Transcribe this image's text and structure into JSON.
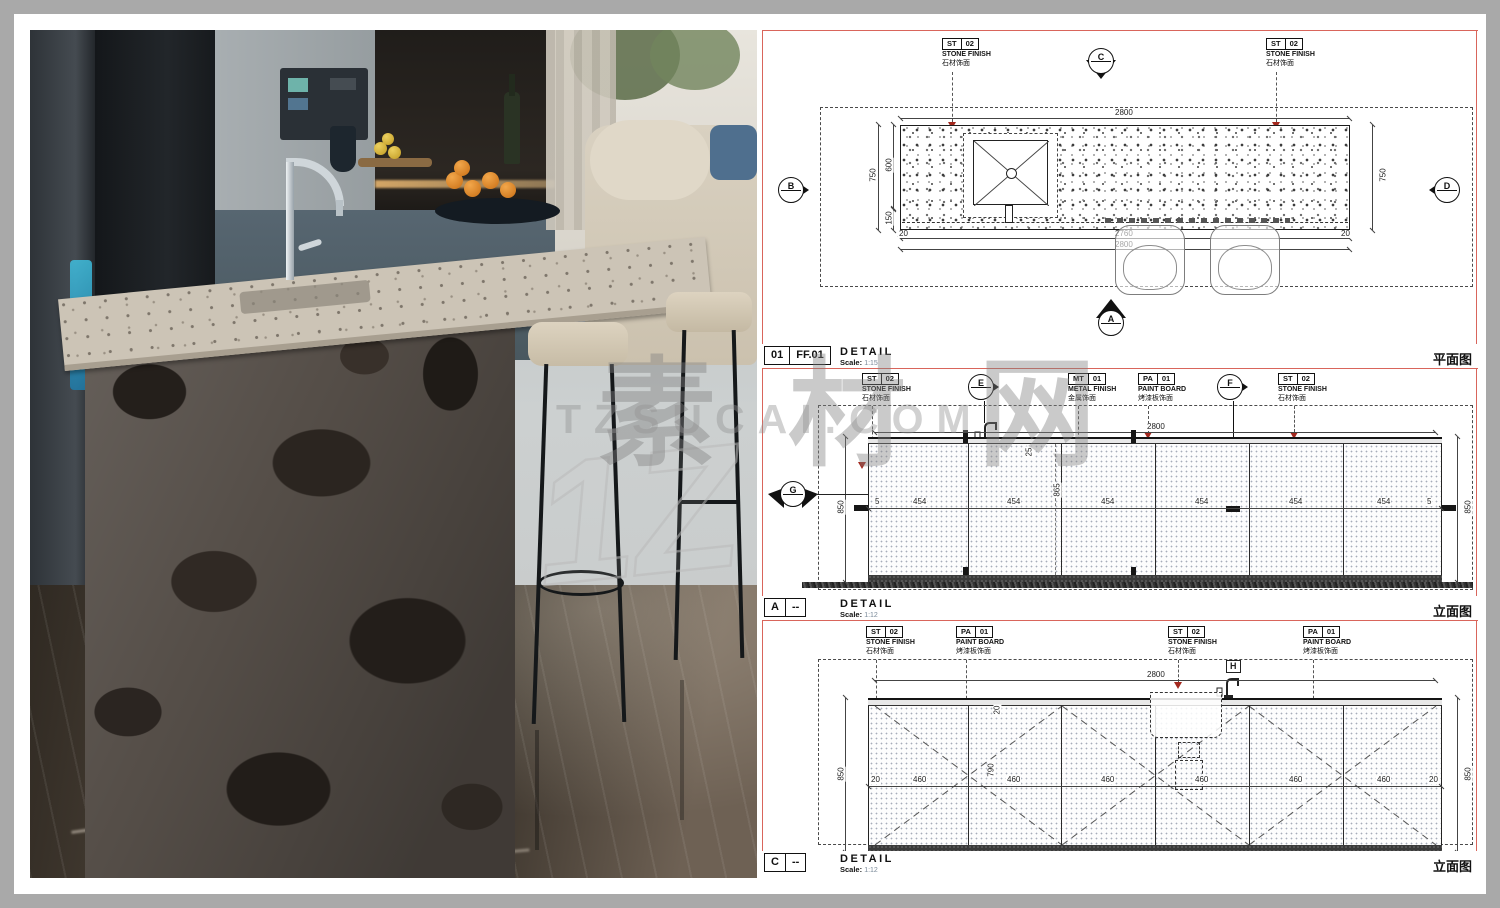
{
  "watermark": {
    "cn": "素材网",
    "url": "TZSUCAI.COM",
    "logo": "1Z"
  },
  "materials": {
    "st": {
      "code": "ST",
      "num": "02",
      "en": "STONE FINISH",
      "cn": "石材饰面"
    },
    "mt": {
      "code": "MT",
      "num": "01",
      "en": "METAL FINISH",
      "cn": "金属饰面"
    },
    "pa": {
      "code": "PA",
      "num": "01",
      "en": "PAINT BOARD",
      "cn": "烤漆板饰面"
    }
  },
  "plan": {
    "markers": {
      "top": "C",
      "left": "B",
      "right": "D",
      "bottom": "A"
    },
    "dims": {
      "top": "2800",
      "left": "750",
      "left_a": "600",
      "left_b": "150",
      "right": "750",
      "bot_l": "20",
      "bot_m": "2760",
      "bot_r": "20",
      "bot_total": "2800"
    },
    "title": {
      "c1": "01",
      "c2": "FF.01",
      "name": "DETAIL",
      "scale_key": "Scale:",
      "scale_val": "1:15",
      "view": "平面图"
    }
  },
  "elevA": {
    "markers": {
      "cut_left": "G",
      "mid": "E",
      "cut_right": "F"
    },
    "dims": {
      "top": "2800",
      "left": "850",
      "right": "850",
      "edge_l": "5",
      "edge_r": "5",
      "vmid": "865",
      "step": "25",
      "row": [
        "454",
        "454",
        "454",
        "454",
        "454",
        "454"
      ]
    },
    "title": {
      "c1": "A",
      "c2": "--",
      "name": "DETAIL",
      "scale_key": "Scale:",
      "scale_val": "1:12",
      "view": "立面图"
    }
  },
  "elevC": {
    "markers": {
      "top": "H"
    },
    "dims": {
      "top": "2800",
      "left": "850",
      "right": "850",
      "vin": "790",
      "tedge": "20",
      "edge_l": "20",
      "edge_r": "20",
      "row": [
        "460",
        "460",
        "460",
        "460",
        "460",
        "460"
      ]
    },
    "title": {
      "c1": "C",
      "c2": "--",
      "name": "DETAIL",
      "scale_key": "Scale:",
      "scale_val": "1:12",
      "view": "立面图"
    }
  }
}
